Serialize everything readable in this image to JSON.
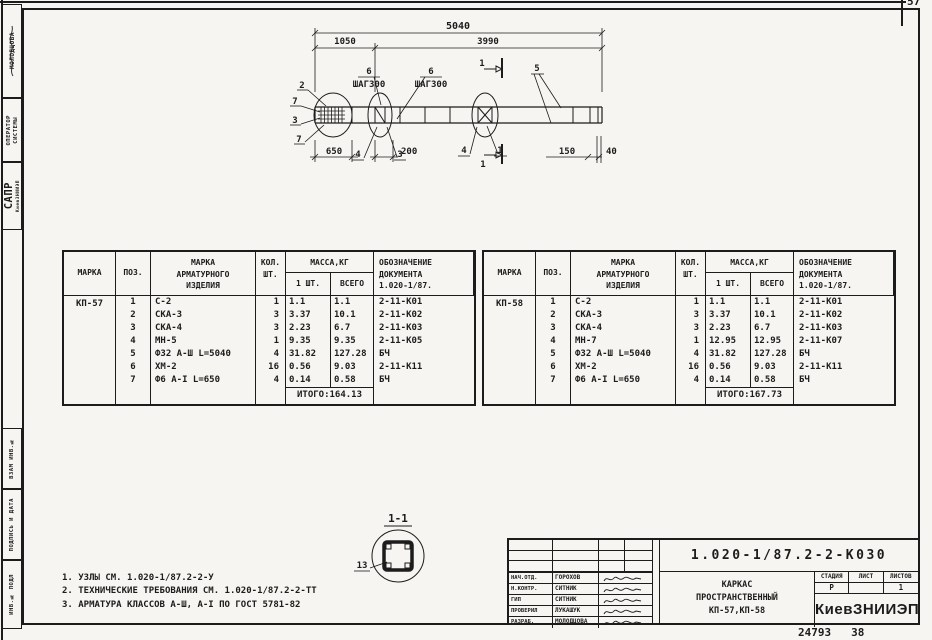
{
  "page": {
    "corner_number": "57",
    "footer_left": "24793",
    "footer_right": "38"
  },
  "left_margin": {
    "author": "МОЛОДЦОВА",
    "operator_l1": "ОПЕРАТОР",
    "operator_l2": "СИСТЕМЫ",
    "sapr": "САПР",
    "sapr_org": "КиевЗНИИЭП",
    "vzam": "ВЗАМ ИНВ.№",
    "podpis": "ПОДПИСЬ И ДАТА",
    "inv": "ИНВ.№ ПОДЛ"
  },
  "drawing": {
    "dims": {
      "total": "5040",
      "left": "1050",
      "right": "3990",
      "step": "ШАГ300",
      "bottom_left": "650",
      "bottom_mid": "200",
      "bottom_right": "150",
      "end": "40"
    },
    "callouts": {
      "c1": "1",
      "c2": "2",
      "c3": "3",
      "c4": "4",
      "c5": "5",
      "c6": "6",
      "c7": "7"
    },
    "section_mark": "1"
  },
  "section_detail": {
    "title": "1-1",
    "bar_label": "13"
  },
  "table_headers": {
    "mark": "МАРКА",
    "pos": "ПОЗ.",
    "item_l1": "МАРКА",
    "item_l2": "АРМАТУРНОГО",
    "item_l3": "ИЗДЕЛИЯ",
    "qty_l1": "КОЛ.",
    "qty_l2": "ШТ.",
    "mass": "МАССА,КГ",
    "mass_one": "1 ШТ.",
    "mass_all": "ВСЕГО",
    "doc_l1": "ОБОЗНАЧЕНИЕ",
    "doc_l2": "ДОКУМЕНТА",
    "doc_l3": "1.020-1/87."
  },
  "tables": [
    {
      "mark": "КП-57",
      "rows": [
        [
          "1",
          "С-2",
          "1",
          "1.1",
          "1.1",
          "2-11-К01"
        ],
        [
          "2",
          "СКА-3",
          "3",
          "3.37",
          "10.1",
          "2-11-К02"
        ],
        [
          "3",
          "СКА-4",
          "3",
          "2.23",
          "6.7",
          "2-11-К03"
        ],
        [
          "4",
          "МН-5",
          "1",
          "9.35",
          "9.35",
          "2-11-К05"
        ],
        [
          "5",
          "Ф32 А-Ш L=5040",
          "4",
          "31.82",
          "127.28",
          "БЧ"
        ],
        [
          "6",
          "ХМ-2",
          "16",
          "0.56",
          "9.03",
          "2-11-К11"
        ],
        [
          "7",
          "Ф6 А-I L=650",
          "4",
          "0.14",
          "0.58",
          "БЧ"
        ]
      ],
      "itogo": "ИТОГО:164.13"
    },
    {
      "mark": "КП-58",
      "rows": [
        [
          "1",
          "С-2",
          "1",
          "1.1",
          "1.1",
          "2-11-К01"
        ],
        [
          "2",
          "СКА-3",
          "3",
          "3.37",
          "10.1",
          "2-11-К02"
        ],
        [
          "3",
          "СКА-4",
          "3",
          "2.23",
          "6.7",
          "2-11-К03"
        ],
        [
          "4",
          "МН-7",
          "1",
          "12.95",
          "12.95",
          "2-11-К07"
        ],
        [
          "5",
          "Ф32 А-Ш L=5040",
          "4",
          "31.82",
          "127.28",
          "БЧ"
        ],
        [
          "6",
          "ХМ-2",
          "16",
          "0.56",
          "9.03",
          "2-11-К11"
        ],
        [
          "7",
          "Ф6 А-I L=650",
          "4",
          "0.14",
          "0.58",
          "БЧ"
        ]
      ],
      "itogo": "ИТОГО:167.73"
    }
  ],
  "notes": [
    "1. УЗЛЫ СМ. 1.020-1/87.2-2-У",
    "2. ТЕХНИЧЕСКИЕ ТРЕБОВАНИЯ СМ. 1.020-1/87.2-2-ТТ",
    "3. АРМАТУРА КЛАССОВ А-Ш, А-I ПО ГОСТ 5781-82"
  ],
  "titleblock": {
    "doc_number": "1.020-1/87.2-2-К030",
    "title_l1": "КАРКАС",
    "title_l2": "ПРОСТРАНСТВЕННЫЙ",
    "title_l3": "КП-57,КП-58",
    "staff": [
      {
        "role": "НАЧ.ОТД.",
        "name": "ГОРОХОВ"
      },
      {
        "role": "Н.КОНТР.",
        "name": "СИТНИК"
      },
      {
        "role": "ГИП",
        "name": "СИТНИК"
      },
      {
        "role": "ПРОВЕРИЛ",
        "name": "ЛУКАШУК"
      },
      {
        "role": "РАЗРАБ.",
        "name": "МОЛОДЦОВА"
      }
    ],
    "stage_label": "СТАДИЯ",
    "sheet_label": "ЛИСТ",
    "sheets_label": "ЛИСТОВ",
    "stage": "Р",
    "sheet": "",
    "sheets": "1",
    "org": "КиевЗНИИЭП"
  }
}
